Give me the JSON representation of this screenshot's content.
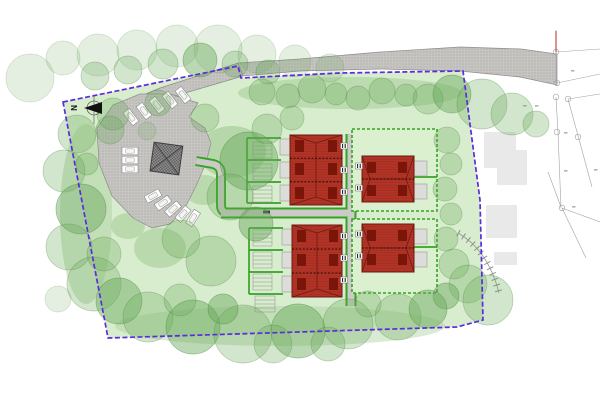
{
  "drawing": {
    "type": "residential-site-plan",
    "north_label": "N"
  },
  "colors": {
    "site": "#d8ecce",
    "garden": "#daf0cf",
    "boundary": "#5b2be0",
    "tree": "#69a95a",
    "treeStroke": "#4e8c41",
    "shrub": "#aed2a0",
    "hedge": "#35a324",
    "path": "#cbcac6",
    "road": "#c6c5c1",
    "roadDot": "#9b9a96",
    "roadStroke": "#8d8d8d",
    "building": "#b23427",
    "buildingDark": "#6e1a10",
    "buildingDeep": "#791509",
    "shed": "#dcdcd8",
    "shedStroke": "#9a9a96",
    "store": "#8a8a8a",
    "storeLine": "#3f3f3f",
    "existing": "#e9e9e9",
    "survey": "#a5a0a5",
    "redline": "#c23b2e",
    "steps": "#8d8d8d"
  },
  "trees": [
    [
      30,
      78,
      24,
      1
    ],
    [
      63,
      58,
      17,
      1
    ],
    [
      98,
      55,
      21,
      1
    ],
    [
      137,
      50,
      20,
      1
    ],
    [
      177,
      46,
      21,
      1
    ],
    [
      218,
      49,
      24,
      1
    ],
    [
      257,
      54,
      19,
      1
    ],
    [
      295,
      61,
      16,
      1
    ],
    [
      330,
      68,
      14,
      1
    ],
    [
      95,
      76,
      14,
      2
    ],
    [
      128,
      70,
      14,
      2
    ],
    [
      163,
      64,
      15,
      2
    ],
    [
      200,
      60,
      17,
      3
    ],
    [
      235,
      64,
      13,
      2
    ],
    [
      268,
      72,
      12,
      2
    ],
    [
      262,
      92,
      13,
      2
    ],
    [
      288,
      96,
      12,
      2
    ],
    [
      312,
      89,
      14,
      2
    ],
    [
      336,
      94,
      11,
      2
    ],
    [
      358,
      98,
      12,
      2
    ],
    [
      382,
      91,
      13,
      2
    ],
    [
      406,
      95,
      11,
      2
    ],
    [
      428,
      99,
      15,
      2
    ],
    [
      452,
      94,
      19,
      3
    ],
    [
      482,
      104,
      25,
      2
    ],
    [
      512,
      114,
      21,
      2
    ],
    [
      536,
      124,
      13,
      2
    ],
    [
      447,
      140,
      13,
      2
    ],
    [
      451,
      164,
      11,
      2
    ],
    [
      445,
      189,
      12,
      2
    ],
    [
      451,
      214,
      11,
      2
    ],
    [
      446,
      239,
      12,
      2
    ],
    [
      454,
      264,
      15,
      2
    ],
    [
      468,
      284,
      19,
      2
    ],
    [
      488,
      300,
      25,
      2
    ],
    [
      446,
      296,
      13,
      3
    ],
    [
      77,
      134,
      19,
      2
    ],
    [
      64,
      171,
      21,
      2
    ],
    [
      81,
      209,
      25,
      3
    ],
    [
      69,
      247,
      23,
      2
    ],
    [
      94,
      284,
      27,
      2
    ],
    [
      119,
      301,
      23,
      3
    ],
    [
      58,
      299,
      13,
      1
    ],
    [
      104,
      254,
      17,
      2
    ],
    [
      87,
      164,
      11,
      2
    ],
    [
      110,
      130,
      14,
      2
    ],
    [
      148,
      317,
      25,
      2
    ],
    [
      193,
      327,
      27,
      3
    ],
    [
      243,
      334,
      29,
      2
    ],
    [
      298,
      331,
      27,
      3
    ],
    [
      348,
      324,
      25,
      2
    ],
    [
      398,
      317,
      23,
      2
    ],
    [
      428,
      309,
      19,
      3
    ],
    [
      273,
      344,
      19,
      2
    ],
    [
      328,
      344,
      17,
      2
    ],
    [
      223,
      309,
      15,
      3
    ],
    [
      368,
      304,
      13,
      2
    ],
    [
      180,
      300,
      16,
      2
    ],
    [
      249,
      161,
      29,
      3
    ],
    [
      230,
      197,
      23,
      2
    ],
    [
      211,
      261,
      25,
      2
    ],
    [
      181,
      239,
      19,
      2
    ],
    [
      256,
      224,
      17,
      3
    ],
    [
      267,
      129,
      15,
      2
    ],
    [
      292,
      118,
      12,
      2
    ],
    [
      113,
      114,
      16,
      2
    ],
    [
      158,
      103,
      13,
      2
    ],
    [
      205,
      118,
      14,
      2
    ],
    [
      147,
      131,
      9,
      1
    ]
  ],
  "shrubs": [
    [
      232,
      152,
      34,
      26,
      0.8
    ],
    [
      204,
      190,
      20,
      15,
      0.7
    ],
    [
      160,
      248,
      26,
      20,
      0.7
    ],
    [
      128,
      226,
      17,
      13,
      0.7
    ],
    [
      350,
      93,
      112,
      16,
      0.65
    ],
    [
      86,
      214,
      26,
      90,
      0.5
    ],
    [
      280,
      326,
      165,
      20,
      0.45
    ]
  ],
  "parking_bays": [
    [
      131,
      117,
      -38
    ],
    [
      144,
      111,
      -38
    ],
    [
      157,
      105,
      -38
    ],
    [
      170,
      100,
      -38
    ],
    [
      183,
      95,
      -38
    ],
    [
      130,
      151,
      90
    ],
    [
      130,
      160,
      90
    ],
    [
      130,
      169,
      90
    ],
    [
      153,
      196,
      62
    ],
    [
      163,
      203,
      55
    ],
    [
      173,
      209,
      48
    ],
    [
      183,
      214,
      40
    ],
    [
      193,
      218,
      33
    ]
  ],
  "entrances": [
    [
      344,
      146
    ],
    [
      344,
      170
    ],
    [
      344,
      192
    ],
    [
      344,
      236
    ],
    [
      344,
      258
    ],
    [
      344,
      280
    ],
    [
      359,
      166
    ],
    [
      359,
      188
    ],
    [
      359,
      234
    ],
    [
      359,
      256
    ]
  ],
  "hedge_lines": [
    [
      247,
      138,
      281,
      138
    ],
    [
      247,
      160,
      281,
      160
    ],
    [
      247,
      182,
      281,
      182
    ],
    [
      247,
      203,
      281,
      203
    ],
    [
      249,
      228,
      283,
      228
    ],
    [
      249,
      250,
      283,
      250
    ],
    [
      249,
      272,
      283,
      272
    ],
    [
      249,
      294,
      283,
      294
    ],
    [
      247,
      138,
      247,
      203
    ],
    [
      249,
      228,
      249,
      294
    ],
    [
      414,
      177,
      437,
      177
    ],
    [
      414,
      247,
      437,
      247
    ]
  ],
  "ladders": [
    [
      253,
      272,
      142,
      158,
      4
    ],
    [
      253,
      272,
      164,
      180,
      4
    ],
    [
      253,
      272,
      186,
      202,
      4
    ],
    [
      253,
      272,
      230,
      246,
      4
    ],
    [
      253,
      272,
      252,
      268,
      4
    ],
    [
      253,
      272,
      274,
      290,
      4
    ],
    [
      255,
      275,
      296,
      312,
      4
    ]
  ],
  "garden_plots": [
    [
      352,
      129,
      85,
      82
    ],
    [
      352,
      219,
      85,
      74
    ]
  ],
  "survey": {
    "lines": [
      [
        556,
        30,
        556,
        83
      ],
      [
        556,
        97,
        558,
        132
      ],
      [
        558,
        132,
        561,
        208
      ],
      [
        556,
        52,
        600,
        49
      ],
      [
        557,
        83,
        600,
        74
      ],
      [
        568,
        99,
        592,
        187
      ],
      [
        568,
        99,
        600,
        94
      ],
      [
        562,
        208,
        586,
        258
      ],
      [
        562,
        208,
        600,
        222
      ],
      [
        548,
        172,
        561,
        207
      ]
    ],
    "circles": [
      [
        556,
        52
      ],
      [
        557,
        83
      ],
      [
        556,
        97
      ],
      [
        568,
        99
      ],
      [
        557,
        132
      ],
      [
        578,
        137
      ],
      [
        562,
        208
      ]
    ],
    "marks": [
      [
        571,
        70
      ],
      [
        523,
        105
      ],
      [
        535,
        105
      ],
      [
        564,
        132
      ],
      [
        564,
        170
      ],
      [
        594,
        169
      ],
      [
        572,
        206
      ]
    ],
    "red_line": [
      556,
      31,
      556,
      52
    ]
  }
}
